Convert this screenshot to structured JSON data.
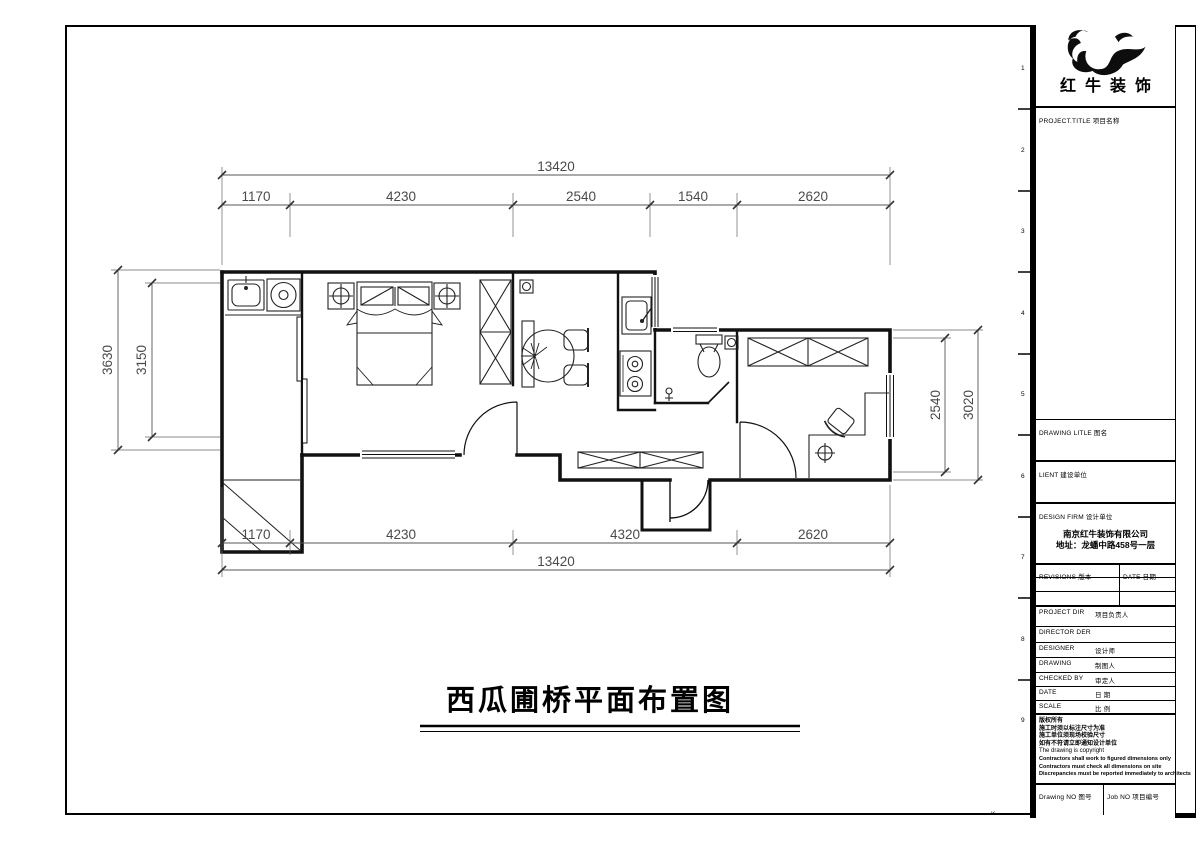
{
  "sheet": {
    "grid_numbers": [
      "1",
      "2",
      "3",
      "4",
      "5",
      "6",
      "7",
      "8",
      "9"
    ],
    "corner_mark": "K"
  },
  "plan": {
    "title": "西瓜圃桥平面布置图",
    "dims": {
      "top_total": "13420",
      "top_segments": [
        "1170",
        "4230",
        "2540",
        "1540",
        "2620"
      ],
      "bottom_segments": [
        "1170",
        "4230",
        "4320",
        "2620"
      ],
      "bottom_total": "13420",
      "left_outer": "3630",
      "left_inner": "3150",
      "right_inner": "2540",
      "right_outer": "3020"
    }
  },
  "title_block": {
    "company_logo_name": "红牛装饰",
    "project_title_label": "PROJECT.TITLE 项目名称",
    "drawing_title_label": "DRAWING LITLE 图名",
    "client_label": "LIENT 建设单位",
    "design_firm_label": "DESIGN FIRM 设计单位",
    "design_firm_name": "南京红牛装饰有限公司",
    "design_firm_address": "地址：龙蟠中路458号一层",
    "revisions_label": "REVISIONS 版本",
    "revision_date_label": "DATE 日期",
    "rows": [
      {
        "en": "PROJECT DIR",
        "cn": "项目负责人"
      },
      {
        "en": "DIRECTOR DER",
        "cn": ""
      },
      {
        "en": "DESIGNER",
        "cn": "设计师"
      },
      {
        "en": "DRAWING",
        "cn": "制图人"
      },
      {
        "en": "CHECKED BY",
        "cn": "审定人"
      },
      {
        "en": "DATE",
        "cn": "日 期"
      },
      {
        "en": "SCALE",
        "cn": "比 例"
      }
    ],
    "copyright_lines_cn": [
      "版权所有",
      "施工时须以标注尺寸为准",
      "施工单位须现场校验尺寸",
      "如有不符请立即通知设计单位"
    ],
    "copyright_note": "The drawing is copyright",
    "copyright_lines_en": [
      "Contractors shall work to figured dimensions only",
      "Contractors must check all dimensions on site",
      "Discrepancies must be reported immediately to architects"
    ],
    "drawing_no_label": "Drawing NO 图号",
    "job_no_label": "Job NO 项目编号"
  }
}
